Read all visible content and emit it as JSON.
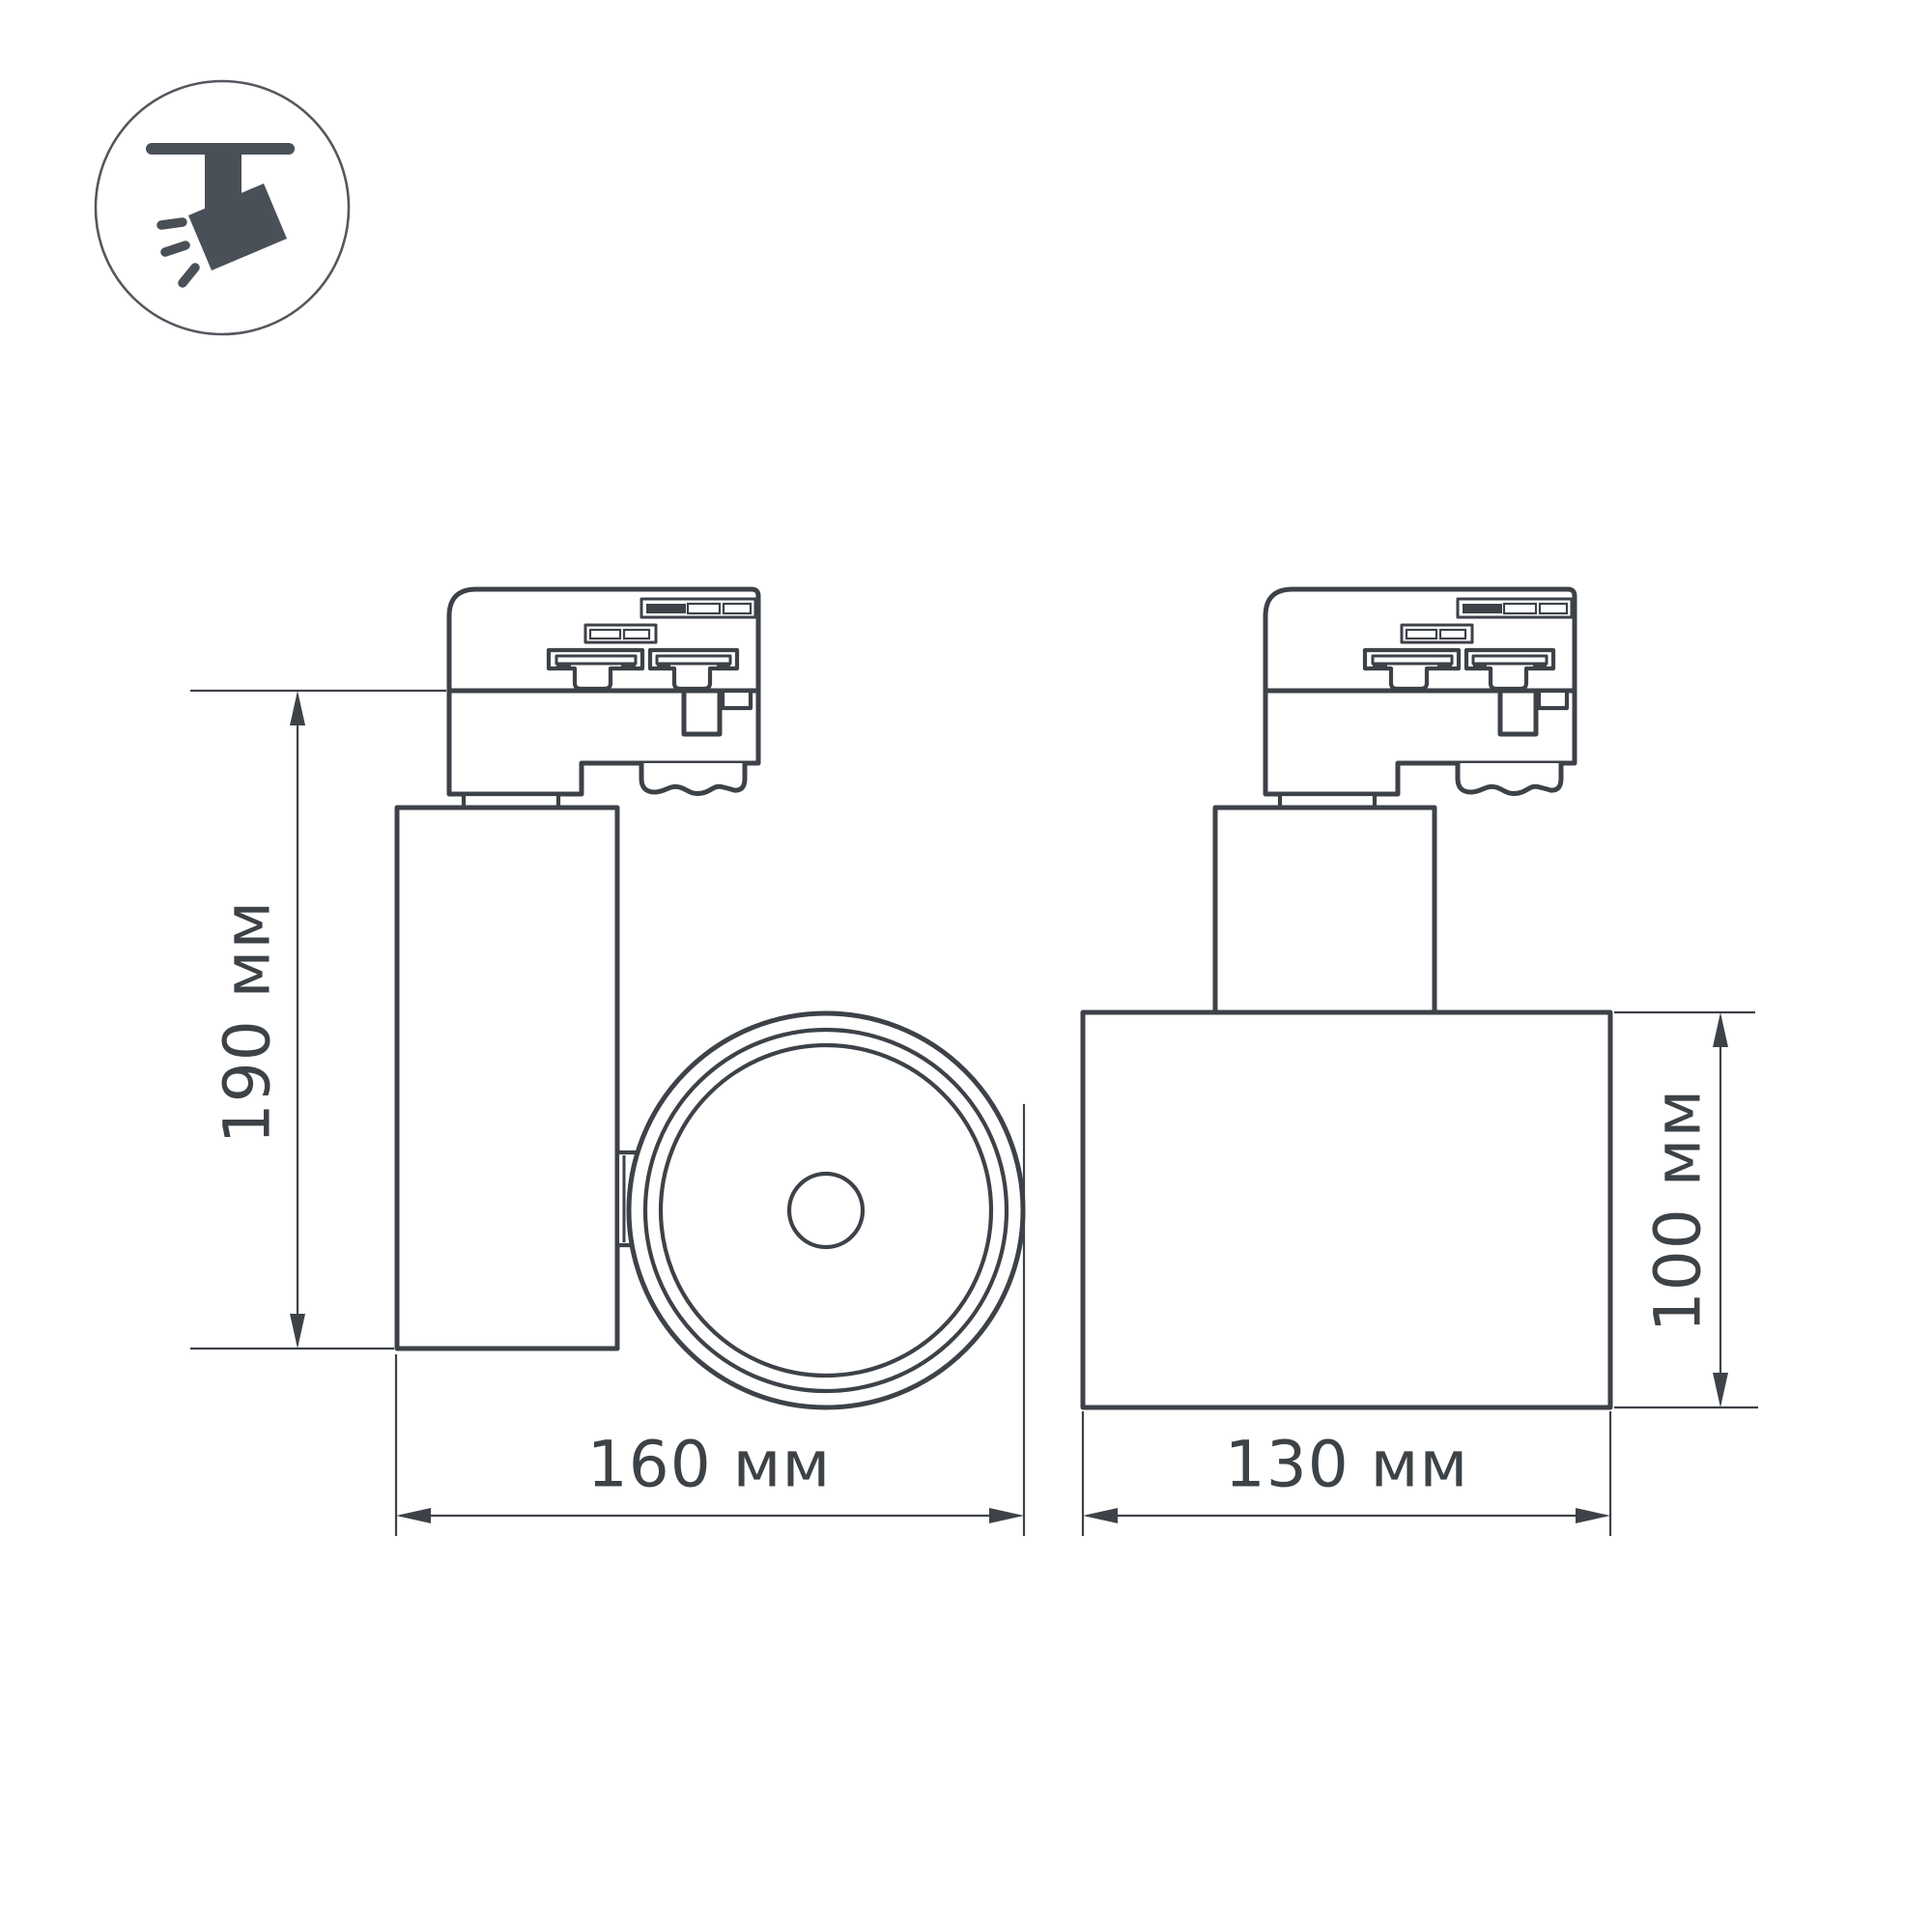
{
  "colors": {
    "background": "#ffffff",
    "line": "#3d4248",
    "text": "#3d4247",
    "icon": "#4a5057",
    "icon_circle": "#53585e"
  },
  "icon": {
    "name": "ceiling-track-spotlight"
  },
  "dimensions": {
    "height": {
      "label": "190 мм",
      "value": 190,
      "unit": "мм"
    },
    "length": {
      "label": "160 мм",
      "value": 160,
      "unit": "мм"
    },
    "width": {
      "label": "130 мм",
      "value": 130,
      "unit": "мм"
    },
    "body_height": {
      "label": "100 мм",
      "value": 100,
      "unit": "мм"
    }
  }
}
